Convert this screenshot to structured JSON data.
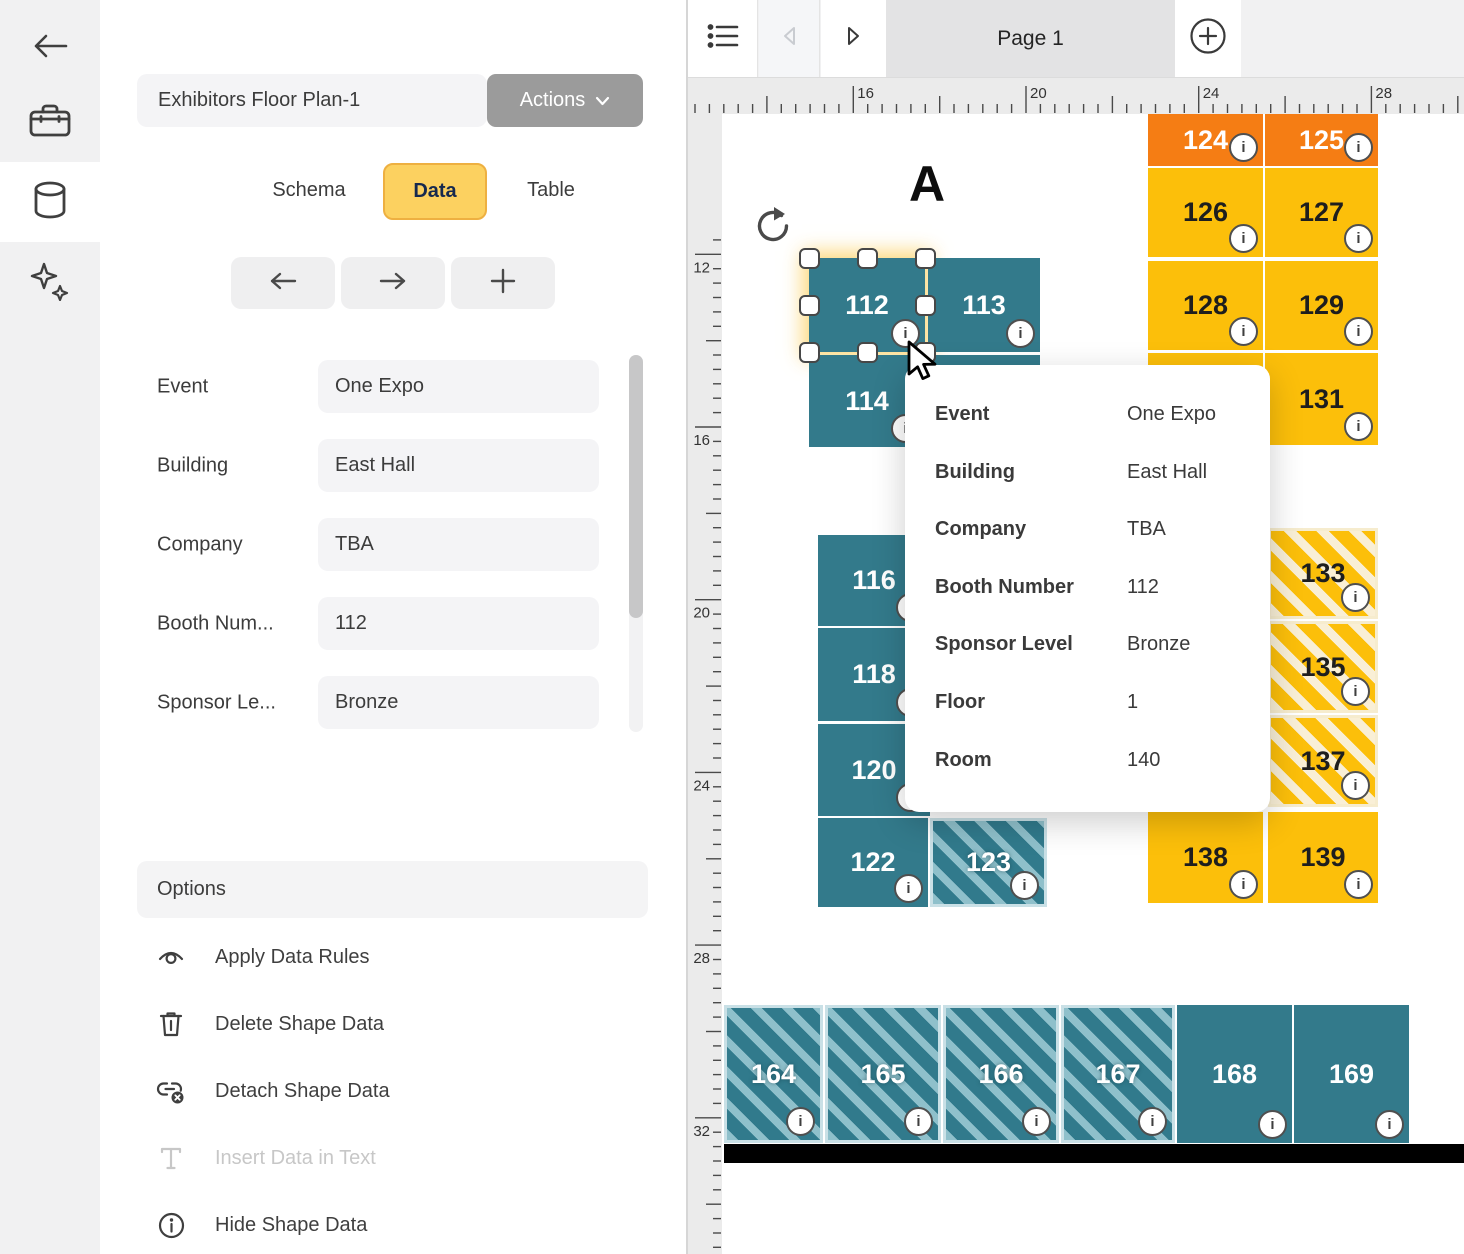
{
  "colors": {
    "teal": "#337A8B",
    "teal_stripe": "#8FC0CB",
    "orange": "#F57D14",
    "yellow": "#FCBF0A",
    "yellow_stripe": "#F9EFD6",
    "tab_active_bg": "#FCD160",
    "actions_bg": "#9B9B9B",
    "page_tab_bg": "#E3E3E4",
    "selection_glow": "#FCD674"
  },
  "sidebar": {
    "items": [
      {
        "icon": "back-arrow-icon",
        "active": false
      },
      {
        "icon": "toolbox-icon",
        "active": false
      },
      {
        "icon": "database-icon",
        "active": true
      },
      {
        "icon": "sparkles-icon",
        "active": false
      }
    ]
  },
  "panel": {
    "title": "Exhibitors Floor Plan-1",
    "actions_label": "Actions",
    "tabs": [
      {
        "label": "Schema",
        "active": false
      },
      {
        "label": "Data",
        "active": true
      },
      {
        "label": "Table",
        "active": false
      }
    ],
    "nav": [
      {
        "icon": "arrow-left-icon"
      },
      {
        "icon": "arrow-right-icon"
      },
      {
        "icon": "plus-icon"
      }
    ],
    "fields": [
      {
        "label": "Event",
        "value": "One Expo"
      },
      {
        "label": "Building",
        "value": "East Hall"
      },
      {
        "label": "Company",
        "value": "TBA"
      },
      {
        "label": "Booth Num...",
        "value": "112"
      },
      {
        "label": "Sponsor Le...",
        "value": "Bronze"
      }
    ],
    "options": {
      "header": "Options",
      "items": [
        {
          "icon": "data-rules-eye-icon",
          "label": "Apply Data Rules",
          "disabled": false
        },
        {
          "icon": "trash-icon",
          "label": "Delete Shape Data",
          "disabled": false
        },
        {
          "icon": "detach-link-icon",
          "label": "Detach Shape Data",
          "disabled": false
        },
        {
          "icon": "text-t-icon",
          "label": "Insert Data in Text",
          "disabled": true
        },
        {
          "icon": "info-circle-icon",
          "label": "Hide Shape Data",
          "disabled": false
        }
      ]
    }
  },
  "canvas": {
    "page_tab_label": "Page 1",
    "zone_label": "A",
    "rulers": {
      "h_labels": [
        "16",
        "20",
        "24",
        "28"
      ],
      "v_labels": [
        "12",
        "16",
        "20",
        "24",
        "28",
        "32"
      ]
    },
    "tooltip": {
      "rows": [
        {
          "label": "Event",
          "value": "One Expo"
        },
        {
          "label": "Building",
          "value": "East Hall"
        },
        {
          "label": "Company",
          "value": "TBA"
        },
        {
          "label": "Booth Number",
          "value": "112"
        },
        {
          "label": "Sponsor Level",
          "value": "Bronze"
        },
        {
          "label": "Floor",
          "value": "1"
        },
        {
          "label": "Room",
          "value": "140"
        }
      ]
    },
    "booths": [
      {
        "n": "112",
        "type": "teal",
        "x": 809,
        "y": 258,
        "w": 116,
        "h": 94,
        "selected": true
      },
      {
        "n": "113",
        "type": "teal",
        "x": 928,
        "y": 258,
        "w": 112,
        "h": 94
      },
      {
        "n": "114",
        "type": "teal",
        "x": 809,
        "y": 355,
        "w": 116,
        "h": 92
      },
      {
        "n": "",
        "type": "teal",
        "x": 928,
        "y": 355,
        "w": 112,
        "h": 92
      },
      {
        "n": "116",
        "type": "teal",
        "x": 818,
        "y": 535,
        "w": 112,
        "h": 91
      },
      {
        "n": "118",
        "type": "teal",
        "x": 818,
        "y": 628,
        "w": 112,
        "h": 93
      },
      {
        "n": "120",
        "type": "teal",
        "x": 818,
        "y": 724,
        "w": 112,
        "h": 92
      },
      {
        "n": "122",
        "type": "teal",
        "x": 818,
        "y": 818,
        "w": 110,
        "h": 89
      },
      {
        "n": "123",
        "type": "teal-h",
        "x": 930,
        "y": 818,
        "w": 117,
        "h": 89
      },
      {
        "n": "124",
        "type": "orange",
        "x": 1148,
        "y": 114,
        "w": 115,
        "h": 52
      },
      {
        "n": "125",
        "type": "orange",
        "x": 1265,
        "y": 114,
        "w": 113,
        "h": 52
      },
      {
        "n": "126",
        "type": "yellow",
        "x": 1148,
        "y": 168,
        "w": 115,
        "h": 89
      },
      {
        "n": "127",
        "type": "yellow",
        "x": 1265,
        "y": 168,
        "w": 113,
        "h": 89
      },
      {
        "n": "128",
        "type": "yellow",
        "x": 1148,
        "y": 261,
        "w": 115,
        "h": 89
      },
      {
        "n": "129",
        "type": "yellow",
        "x": 1265,
        "y": 261,
        "w": 113,
        "h": 89
      },
      {
        "n": "",
        "type": "yellow",
        "x": 1148,
        "y": 353,
        "w": 115,
        "h": 92
      },
      {
        "n": "131",
        "type": "yellow",
        "x": 1265,
        "y": 353,
        "w": 113,
        "h": 92
      },
      {
        "n": "133",
        "type": "yellow-h",
        "x": 1268,
        "y": 528,
        "w": 110,
        "h": 91
      },
      {
        "n": "135",
        "type": "yellow-h",
        "x": 1268,
        "y": 621,
        "w": 110,
        "h": 92
      },
      {
        "n": "137",
        "type": "yellow-h",
        "x": 1268,
        "y": 715,
        "w": 110,
        "h": 92
      },
      {
        "n": "138",
        "type": "yellow",
        "x": 1148,
        "y": 812,
        "w": 115,
        "h": 91
      },
      {
        "n": "139",
        "type": "yellow",
        "x": 1268,
        "y": 812,
        "w": 110,
        "h": 91
      },
      {
        "n": "164",
        "type": "teal-h",
        "x": 724,
        "y": 1005,
        "w": 99,
        "h": 138
      },
      {
        "n": "165",
        "type": "teal-h",
        "x": 825,
        "y": 1005,
        "w": 116,
        "h": 138
      },
      {
        "n": "166",
        "type": "teal-h",
        "x": 943,
        "y": 1005,
        "w": 116,
        "h": 138
      },
      {
        "n": "167",
        "type": "teal-h",
        "x": 1061,
        "y": 1005,
        "w": 114,
        "h": 138
      },
      {
        "n": "168",
        "type": "teal",
        "x": 1177,
        "y": 1005,
        "w": 115,
        "h": 138
      },
      {
        "n": "169",
        "type": "teal",
        "x": 1294,
        "y": 1005,
        "w": 115,
        "h": 138
      }
    ],
    "wall": {
      "x": 724,
      "y": 1144,
      "w": 740,
      "h": 19
    }
  }
}
